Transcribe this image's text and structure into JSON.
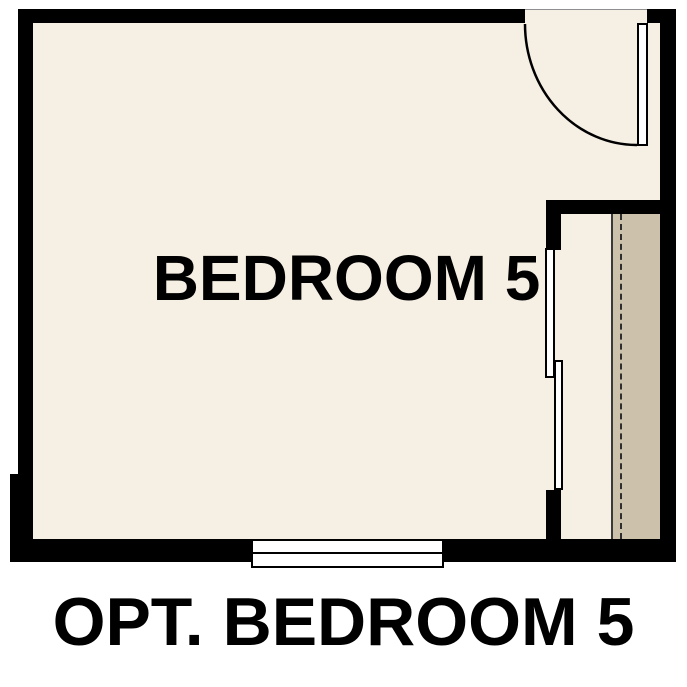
{
  "floor_plan": {
    "room_label": "BEDROOM 5",
    "caption": "OPT. BEDROOM 5",
    "features": {
      "door_icon": "hinged-door-swing-arc",
      "window_icon": "double-line-window",
      "closet_door_icon": "bypass-sliding-panels",
      "closet_rod_icon": "dashed-hanging-rod-line",
      "closet_shelf_icon": "shelf-band"
    },
    "colors": {
      "wall": "#000000",
      "floor": "#f6efe4",
      "closet_shelf": "#ccc2ab",
      "page_background": "#ffffff",
      "label_text": "#000000"
    }
  }
}
